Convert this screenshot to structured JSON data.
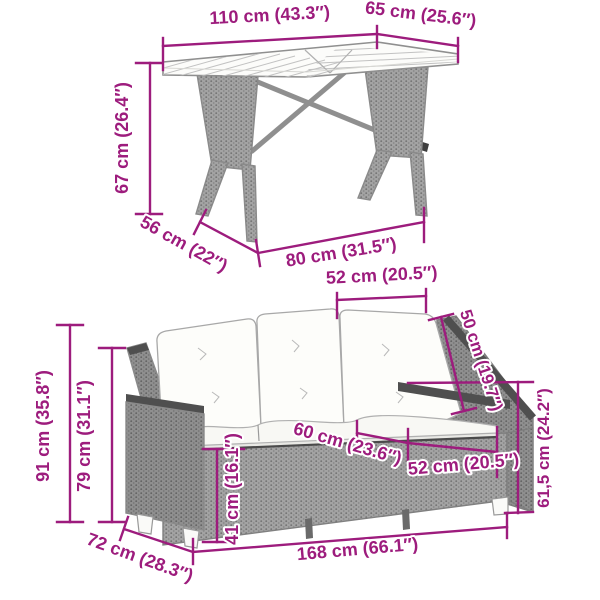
{
  "figure": {
    "kind": "product-dimension-diagram",
    "accent_color": "#9d1c7d",
    "items": [
      "poly-rattan garden table",
      "poly-rattan garden sofa with cushions"
    ]
  },
  "labels": [
    {
      "id": "table-top-length",
      "text": "110 cm (43.3″)"
    },
    {
      "id": "table-top-depth",
      "text": "65 cm (25.6″)"
    },
    {
      "id": "table-height",
      "text": "67 cm (26.4″)"
    },
    {
      "id": "table-base-depth",
      "text": "56 cm (22″)"
    },
    {
      "id": "table-base-width",
      "text": "80 cm (31.5″)"
    },
    {
      "id": "sofa-back-cushion-width",
      "text": "52 cm (20.5″)"
    },
    {
      "id": "sofa-backrest-height",
      "text": "50 cm (19.7″)"
    },
    {
      "id": "sofa-total-height",
      "text": "91 cm (35.8″)"
    },
    {
      "id": "sofa-armrest-height",
      "text": "79 cm (31.1″)"
    },
    {
      "id": "sofa-seat-height",
      "text": "41 cm (16.1″)"
    },
    {
      "id": "sofa-seat-depth",
      "text": "60 cm (23.6″)"
    },
    {
      "id": "sofa-seat-width",
      "text": "52 cm (20.5″)"
    },
    {
      "id": "sofa-reclined-height",
      "text": "61,5 cm (24.2″)"
    },
    {
      "id": "sofa-depth",
      "text": "72 cm (28.3″)"
    },
    {
      "id": "sofa-total-width",
      "text": "168 cm (66.1″)"
    }
  ]
}
